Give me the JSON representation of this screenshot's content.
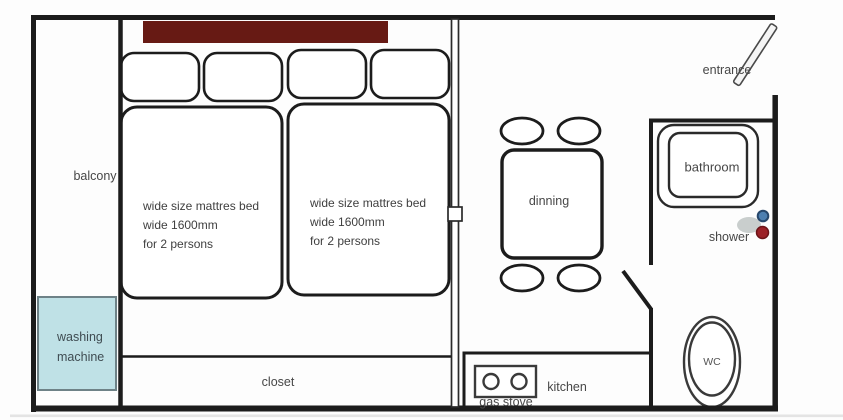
{
  "title": "apartment floor plan",
  "colors": {
    "wall": "#1c1c1c",
    "headboard": "#671a14",
    "washing_machine_fill": "#bfe1e6",
    "washing_machine_border": "#6e8287",
    "shower_gray": "#c9cecd",
    "shower_blue": "#4d7fb0",
    "shower_blue_ring": "#27476b",
    "shower_red": "#9c2127",
    "shower_red_ring": "#6b1418",
    "text": "#474747"
  },
  "labels": {
    "balcony": "balcony",
    "entrance": "entrance",
    "bathroom": "bathroom",
    "shower": "shower",
    "wc": "WC",
    "dining": "dinning",
    "kitchen": "kitchen",
    "gas_stove": "gas stove",
    "closet": "closet",
    "washing_machine_line1": "washing",
    "washing_machine_line2": "machine"
  },
  "beds": {
    "left": {
      "line1": "wide size mattres bed",
      "line2": "wide 1600mm",
      "line3": "for 2 persons"
    },
    "right": {
      "line1": "wide size mattres bed",
      "line2": "wide 1600mm",
      "line3": "for 2 persons"
    }
  }
}
